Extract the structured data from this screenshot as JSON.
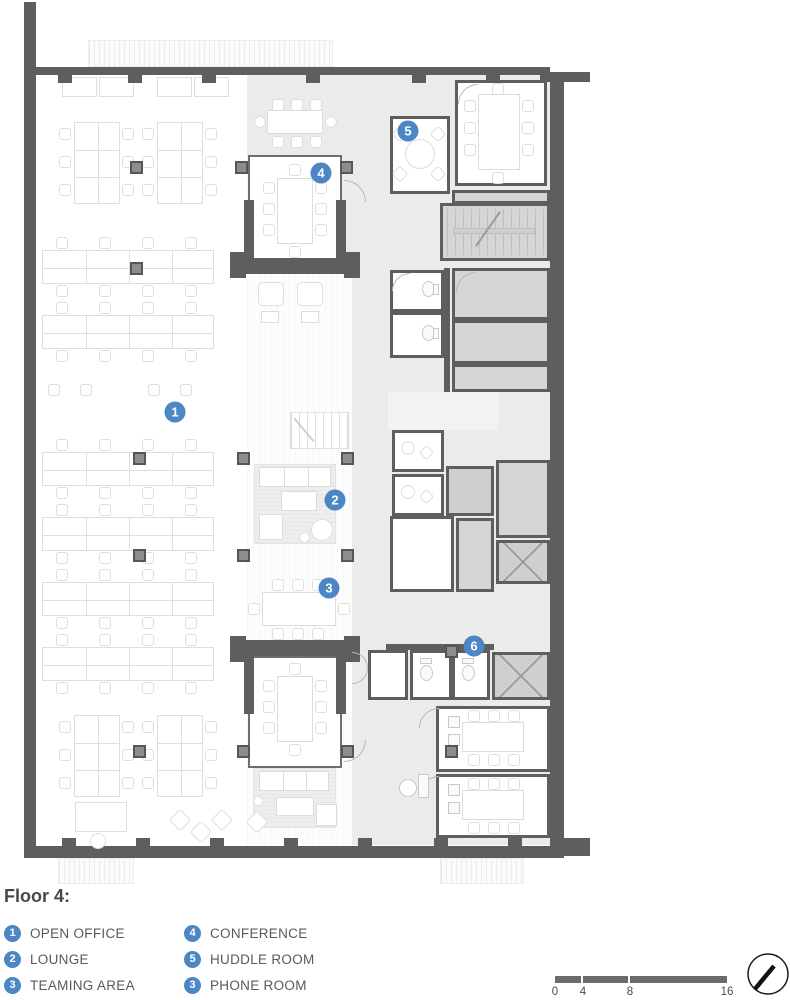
{
  "document": {
    "type": "architectural floor plan",
    "floor": "4"
  },
  "plan": {
    "markers": [
      {
        "n": "1",
        "x": 175,
        "y": 412
      },
      {
        "n": "2",
        "x": 335,
        "y": 500
      },
      {
        "n": "3",
        "x": 329,
        "y": 588
      },
      {
        "n": "4",
        "x": 321,
        "y": 173
      },
      {
        "n": "5",
        "x": 408,
        "y": 131
      },
      {
        "n": "6",
        "x": 474,
        "y": 646
      }
    ]
  },
  "legend": {
    "title": "Floor 4:",
    "columns": [
      [
        {
          "badge": "1",
          "label": "OPEN OFFICE"
        },
        {
          "badge": "2",
          "label": "LOUNGE"
        },
        {
          "badge": "3",
          "label": "TEAMING AREA"
        }
      ],
      [
        {
          "badge": "4",
          "label": "CONFERENCE"
        },
        {
          "badge": "5",
          "label": "HUDDLE ROOM"
        },
        {
          "badge": "3",
          "label": "PHONE ROOM"
        }
      ]
    ]
  },
  "scale_bar": {
    "ticks": [
      "0",
      "4",
      "8",
      "16"
    ]
  },
  "north_symbol": "north-arrow",
  "colors": {
    "marker_blue": "#4C86C5",
    "wall_gray": "#5e5e5e",
    "floor_gray": "#ebebeb",
    "service_gray": "#d5d5d4"
  }
}
